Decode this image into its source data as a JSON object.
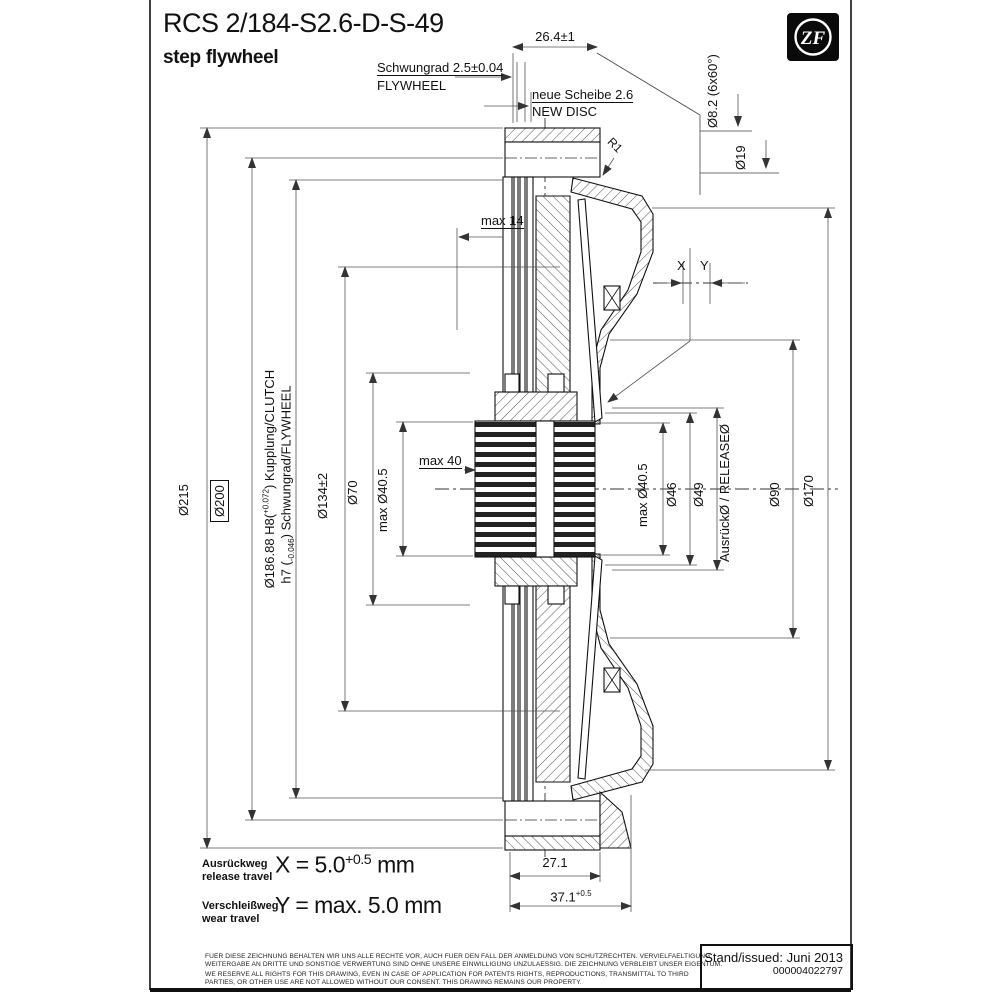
{
  "header": {
    "drawing_code": "RCS 2/184-S2.6-D-S-49",
    "drawing_type": "step flywheel"
  },
  "logo": {
    "brand": "ZF"
  },
  "callouts": {
    "flywheel_de": "Schwungrad 2.5±0.04",
    "flywheel_en": "FLYWHEEL",
    "new_disc_de": "neue Scheibe 2.6",
    "new_disc_en": "NEW DISC",
    "width_top": "26.4±1",
    "max_depth": "max 14",
    "max_hub_width": "max 40",
    "radius": "R1",
    "x": "X",
    "y": "Y"
  },
  "dims": {
    "left": {
      "outer": "Ø215",
      "friction": "Ø200",
      "fit_pre": "Ø186.88 H8(",
      "fit_sup": "+0.072",
      "fit_post": ") Kupplung/CLUTCH",
      "fit2_pre": "h7 (",
      "fit2_sub": "-0.046",
      "fit2_post": ") Schwungrad/FLYWHEEL",
      "bolt_circle": "Ø134±2",
      "hub": "Ø70",
      "spline": "max Ø40.5"
    },
    "right": {
      "spline": "max Ø40.5",
      "inner1": "Ø46",
      "inner2": "Ø49",
      "release": "AusrückØ / RELEASEØ",
      "spring": "Ø90",
      "cover": "Ø170",
      "holes": "Ø8.2 (6x60°)",
      "dowel": "Ø19"
    },
    "bottom": {
      "rim": "27.1",
      "total": "37.1",
      "total_sup": "+0.5"
    }
  },
  "travel": {
    "x_label_de": "Ausrückweg",
    "x_label_en": "release travel",
    "x_eq": "X = 5.0",
    "x_sup": "+0.5",
    "x_unit": "mm",
    "y_label_de": "Verschleißweg",
    "y_label_en": "wear travel",
    "y_eq": "Y = max. 5.0 mm"
  },
  "legal": {
    "de1": "FUER DIESE ZEICHNUNG BEHALTEN WIR UNS ALLE RECHTE VOR, AUCH FUER DEN FALL DER ANMELDUNG VON SCHUTZRECHTEN. VERVIELFAELTIGUNG,",
    "de2": "WEITERGABE AN DRITTE UND SONSTIGE VERWERTUNG SIND OHNE UNSERE EINWILLIGUNG UNZULAESSIG. DIE ZEICHNUNG VERBLEIBT UNSER EIGENTUM.",
    "en1": "WE RESERVE ALL RIGHTS FOR THIS DRAWING, EVEN IN CASE OF APPLICATION FOR PATENTS RIGHTS, REPRODUCTIONS, TRANSMITTAL TO THIRD",
    "en2": "PARTIES, OR OTHER USE ARE NOT ALLOWED WITHOUT OUR CONSENT. THIS DRAWING REMAINS OUR PROPERTY."
  },
  "issued": {
    "label": "Stand/issued: Juni 2013",
    "number": "000004022797"
  }
}
